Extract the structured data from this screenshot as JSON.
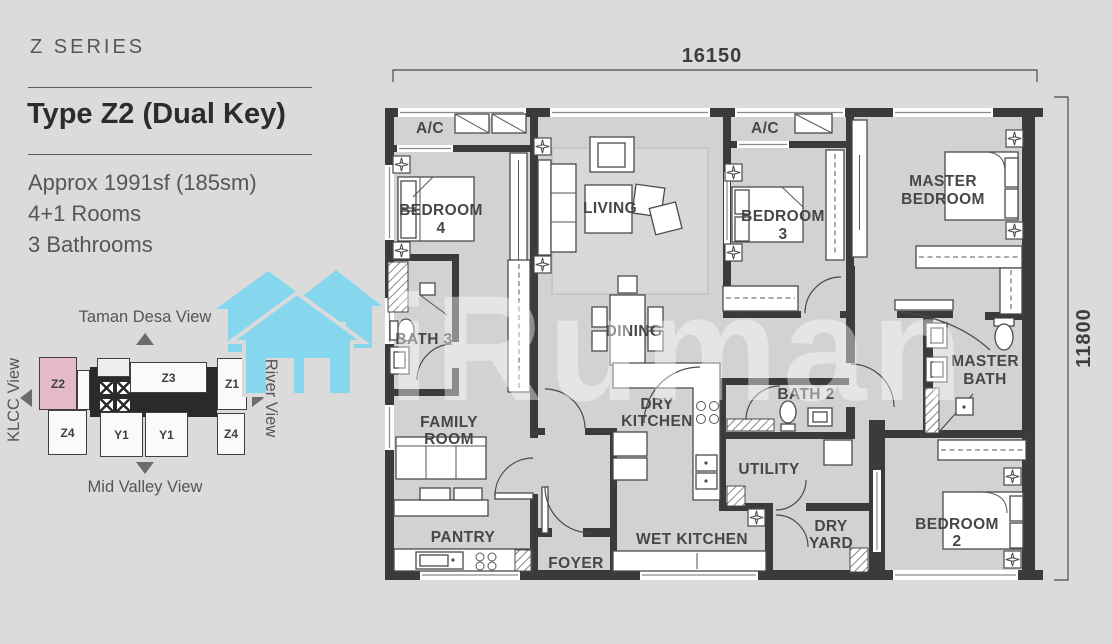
{
  "sidebar": {
    "series_label": "Z SERIES",
    "title": "Type Z2 (Dual Key)",
    "area": "Approx 1991sf (185sm)",
    "rooms_line": "4+1 Rooms",
    "baths_line": "3 Bathrooms"
  },
  "key_plan": {
    "view_top": "Taman Desa View",
    "view_left": "KLCC View",
    "view_right": "River View",
    "view_bottom": "Mid Valley View",
    "units": {
      "z2": "Z2",
      "z3": "Z3",
      "z1": "Z1",
      "z4_left": "Z4",
      "y1_left": "Y1",
      "y1_right": "Y1",
      "z4_right": "Z4"
    },
    "highlighted_unit": "Z2",
    "highlight_color": "#e5b9ca"
  },
  "plan": {
    "dim_top": "16150",
    "dim_right": "11800",
    "wall_color": "#3b3b3d",
    "floor_color": "#d2d2d3",
    "labels": {
      "ac_left": "A/C",
      "ac_right": "A/C",
      "bedroom4": [
        "BEDROOM",
        "4"
      ],
      "living": "LIVING",
      "bedroom3": [
        "BEDROOM",
        "3"
      ],
      "master_bedroom": [
        "MASTER",
        "BEDROOM"
      ],
      "bath3": "BATH 3",
      "dining": "DINING",
      "master_bath": [
        "MASTER",
        "BATH"
      ],
      "bath2": "BATH 2",
      "family_room": [
        "FAMILY",
        "ROOM"
      ],
      "dry_kitchen": [
        "DRY",
        "KITCHEN"
      ],
      "utility": "UTILITY",
      "pantry": "PANTRY",
      "foyer": "FOYER",
      "wet_kitchen": "WET KITCHEN",
      "dry_yard": [
        "DRY",
        "YARD"
      ],
      "bedroom2": [
        "BEDROOM",
        "2"
      ]
    }
  },
  "watermark": {
    "text": "iRuman",
    "icon": "house-icon",
    "icon_color": "#86d7ee"
  }
}
